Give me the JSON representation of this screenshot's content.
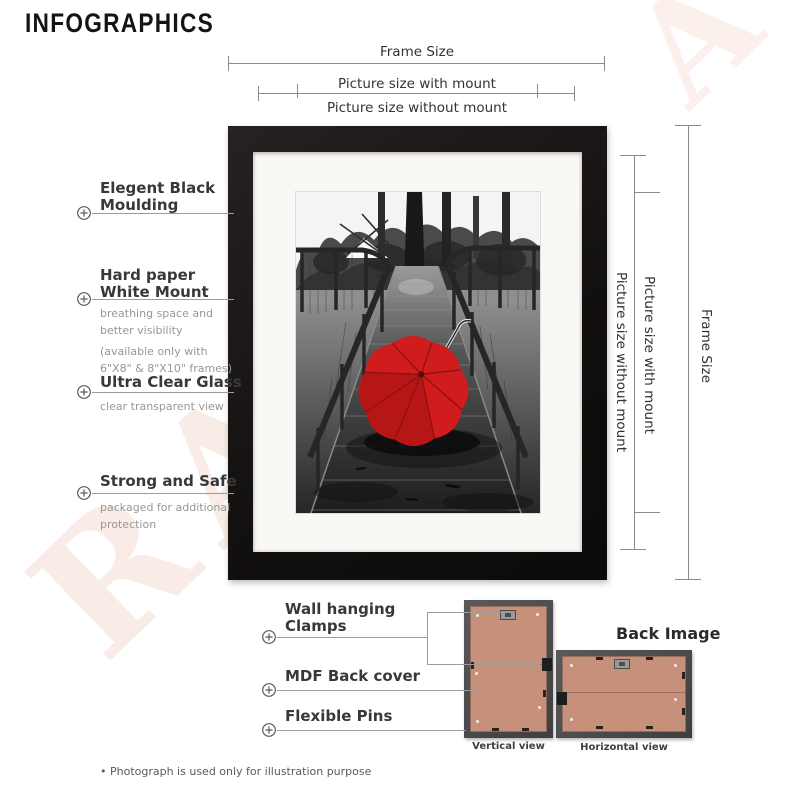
{
  "title": "INFOGRAPHICS",
  "dimension_labels": {
    "frame_size": "Frame Size",
    "with_mount": "Picture size with mount",
    "without_mount": "Picture size without mount"
  },
  "features": [
    {
      "title": "Elegent Black\nMoulding"
    },
    {
      "title": "Hard paper\nWhite Mount",
      "description": "breathing space and\nbetter visibility",
      "note": "(available only with\n6\"X8\" & 8\"X10\" frames)"
    },
    {
      "title": "Ultra Clear Glass",
      "description": "clear transparent view"
    },
    {
      "title": "Strong and Safe",
      "description": "packaged for additional\nprotection"
    }
  ],
  "back_features": [
    {
      "title": "Wall hanging\nClamps"
    },
    {
      "title": "MDF Back cover"
    },
    {
      "title": "Flexible Pins"
    }
  ],
  "back_section": {
    "heading": "Back Image",
    "vertical_view_label": "Vertical view",
    "horizontal_view_label": "Horizontal view"
  },
  "watermark": {
    "bottom_left": "RA",
    "top_right": "A"
  },
  "footnote": "• Photograph is used only for illustration purpose",
  "photo_alt": "black and white boardwalk with red umbrella",
  "colors": {
    "frame_black": "#171414",
    "mount_white": "#f9f8f5",
    "mdf_tan": "#c6907a",
    "umbrella_red": "#d01c1c",
    "watermark_pink": "#f3d2c7"
  }
}
